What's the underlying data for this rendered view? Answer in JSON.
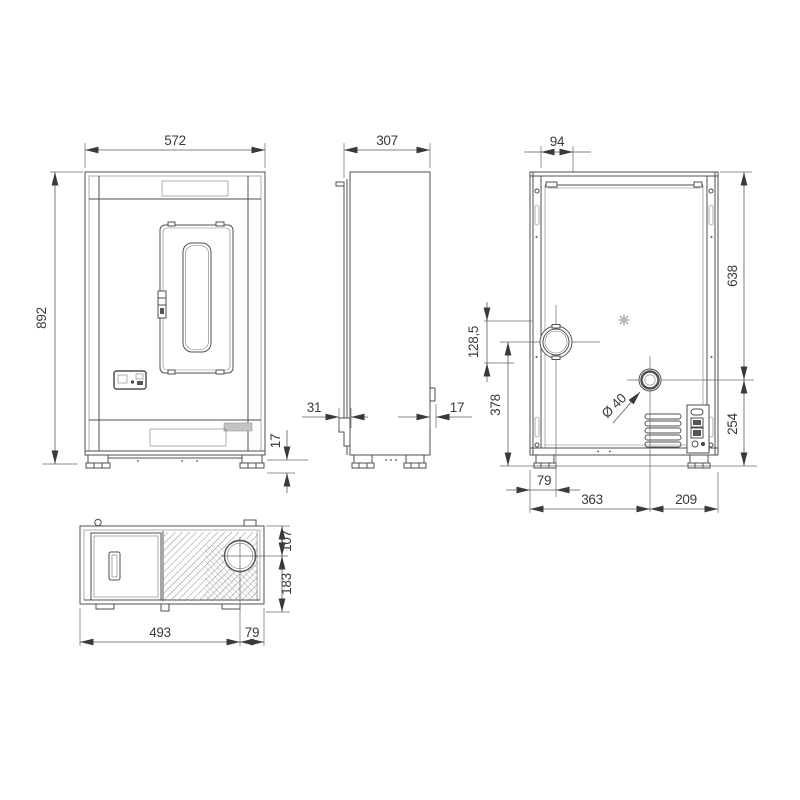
{
  "drawing": {
    "type": "technical-dimension-drawing",
    "views": [
      "front",
      "side",
      "back",
      "top"
    ],
    "unit": "mm"
  },
  "dims": {
    "front_width": "572",
    "front_height": "892",
    "front_plinth_height": "17",
    "side_depth": "307",
    "side_front_step": "31",
    "side_rear_offset": "17",
    "back_flue_top_offset": "94",
    "back_top_to_inlet": "638",
    "back_flue_span": "128,5",
    "back_flue_to_floor": "378",
    "back_inlet_diameter": "Ø 40",
    "back_left_to_flue": "79",
    "back_left_to_inlet": "363",
    "back_inlet_to_right": "209",
    "back_inlet_to_floor": "254",
    "top_left_to_flue": "493",
    "top_flue_to_right": "79",
    "top_edge_to_flue": "107",
    "top_flue_to_bottom": "183"
  },
  "colors": {
    "line": "#4f4f4f",
    "dim_text": "#3a3a3a",
    "background": "#ffffff",
    "label_fill": "#c4c4c4"
  }
}
